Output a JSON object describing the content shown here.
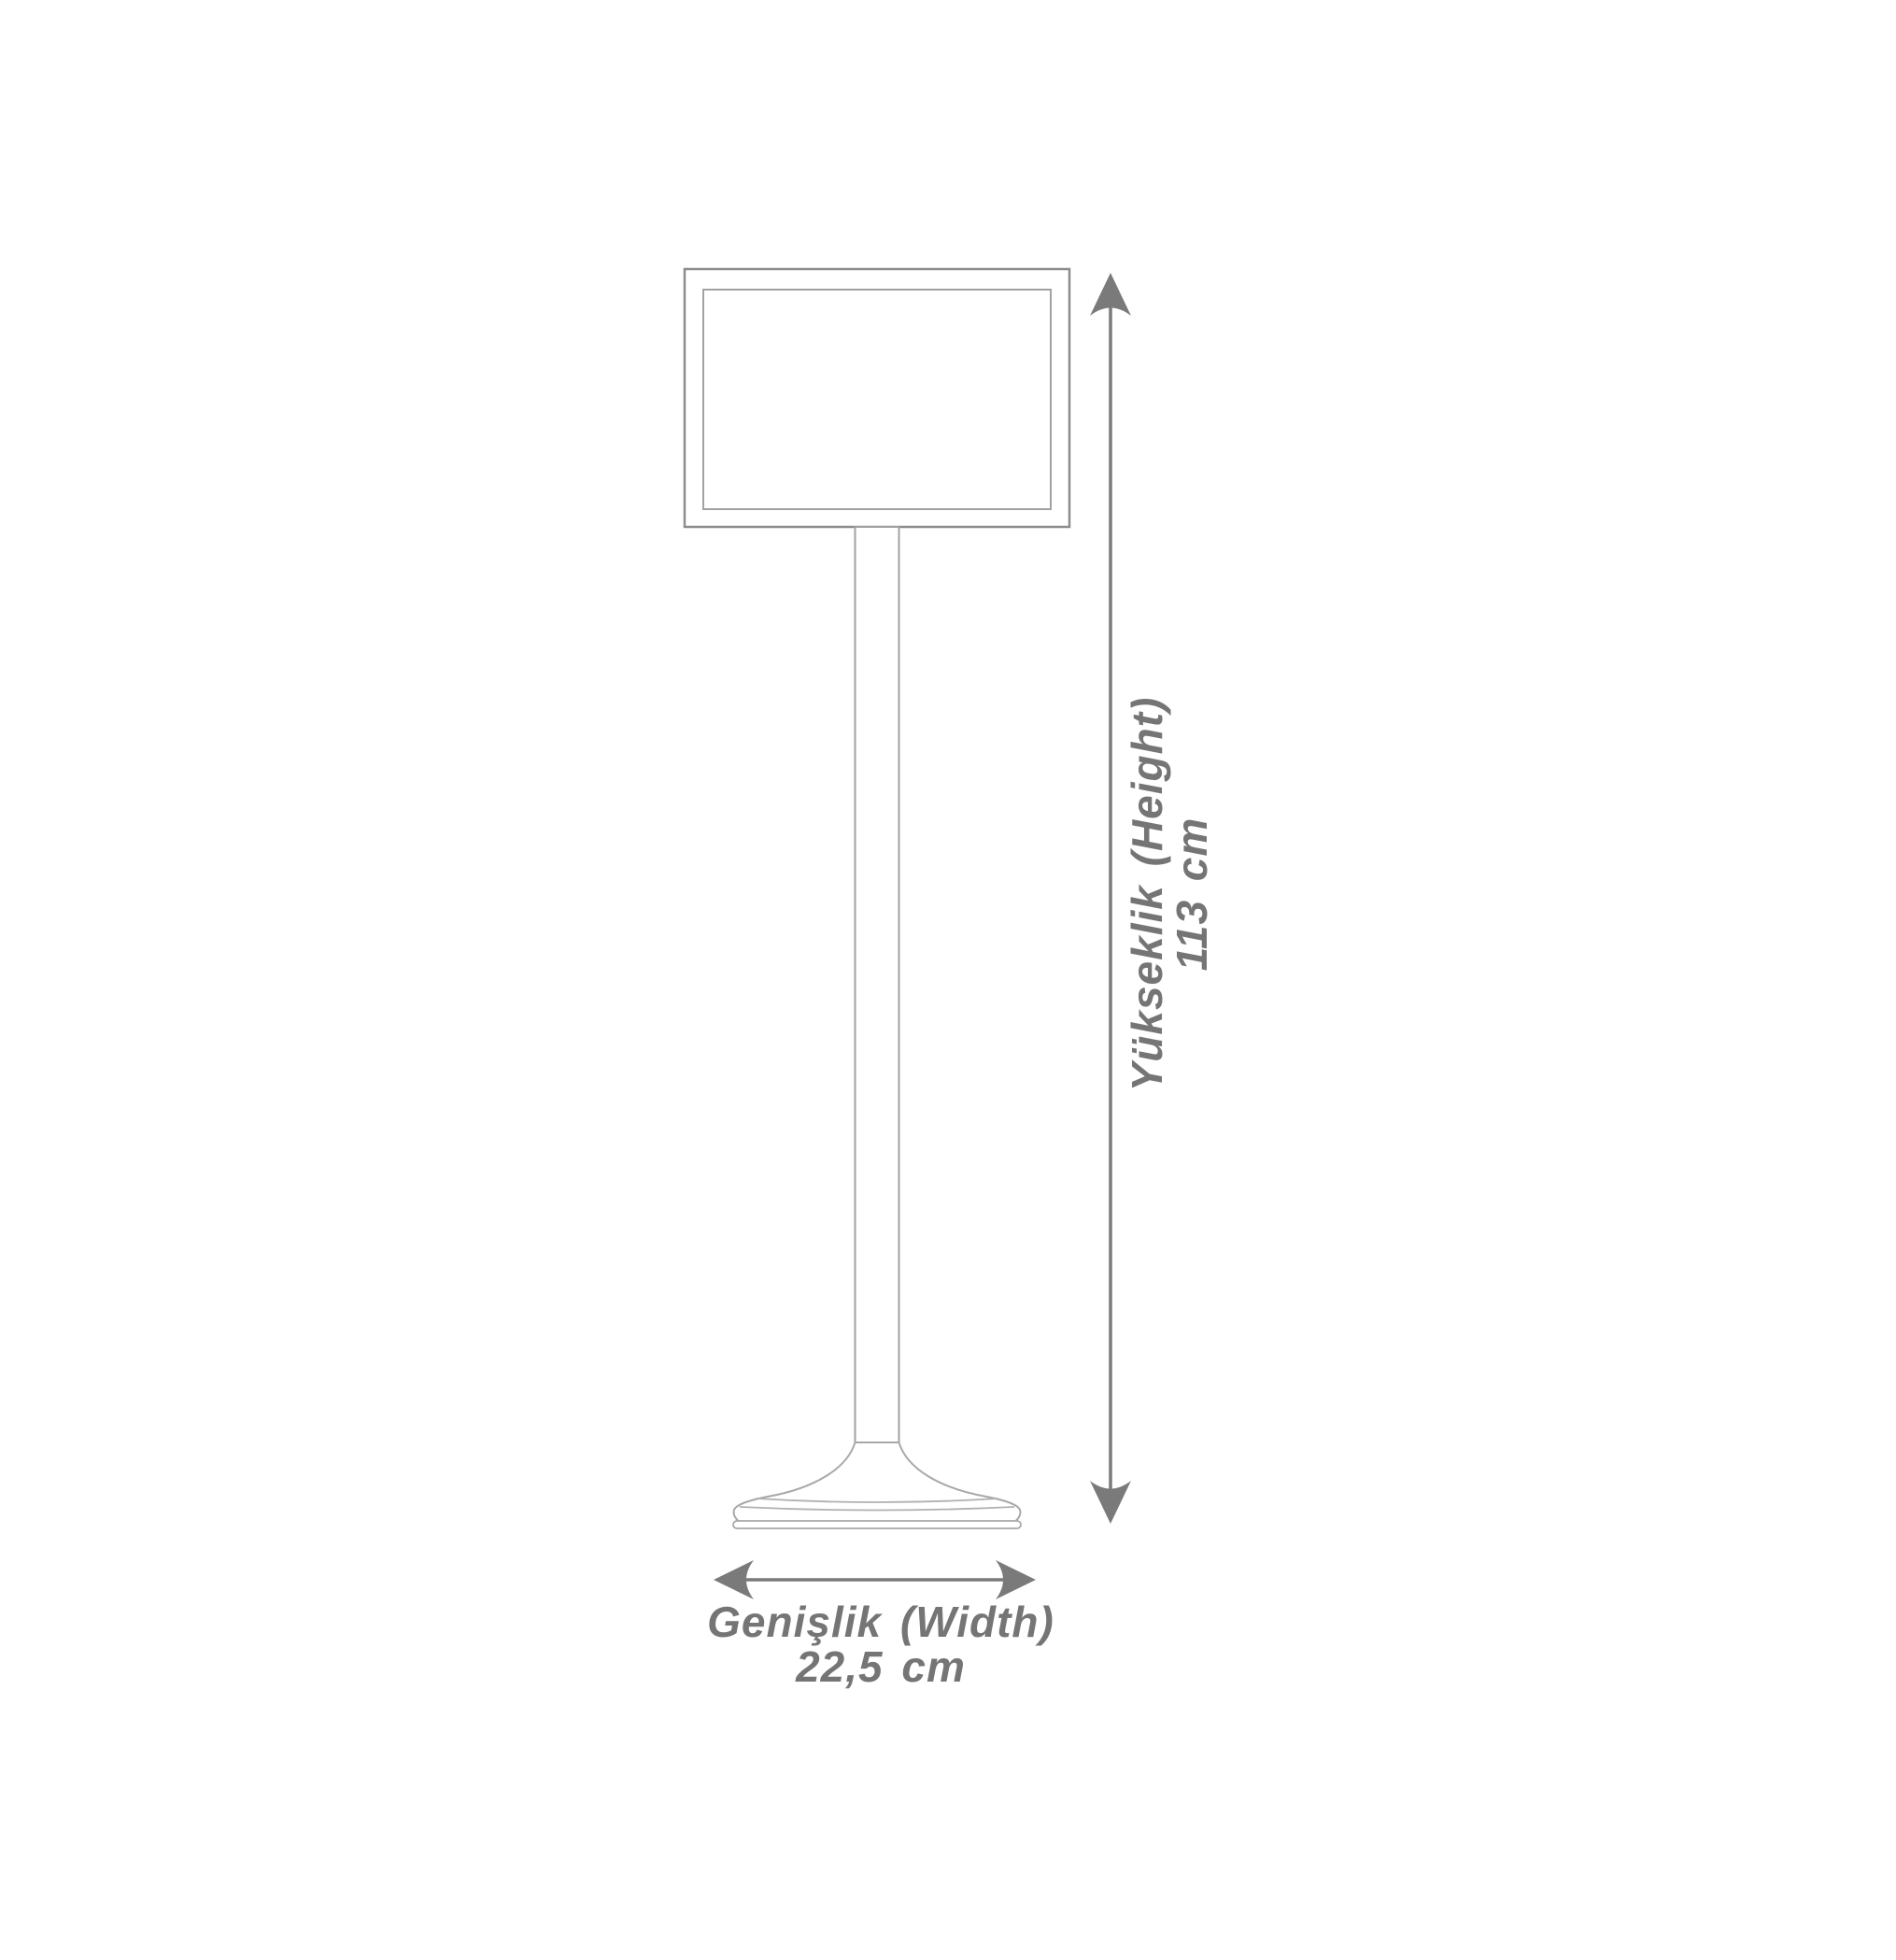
{
  "page": {
    "background_color": "#ffffff"
  },
  "drawing": {
    "subject": "sign-stand-outline",
    "outline_color": "#a2a2a2",
    "frame_outline_color": "#8c8c8c",
    "dimension_color": "#757575"
  },
  "labels": {
    "height": {
      "title": "Yükseklik (Height)",
      "value": "113 cm"
    },
    "width": {
      "title": "Genişlik (Width)",
      "value": "22,5 cm"
    }
  },
  "icons": {
    "vertical_dimension": "double-headed-arrow-vertical",
    "horizontal_dimension": "double-headed-arrow-horizontal"
  }
}
